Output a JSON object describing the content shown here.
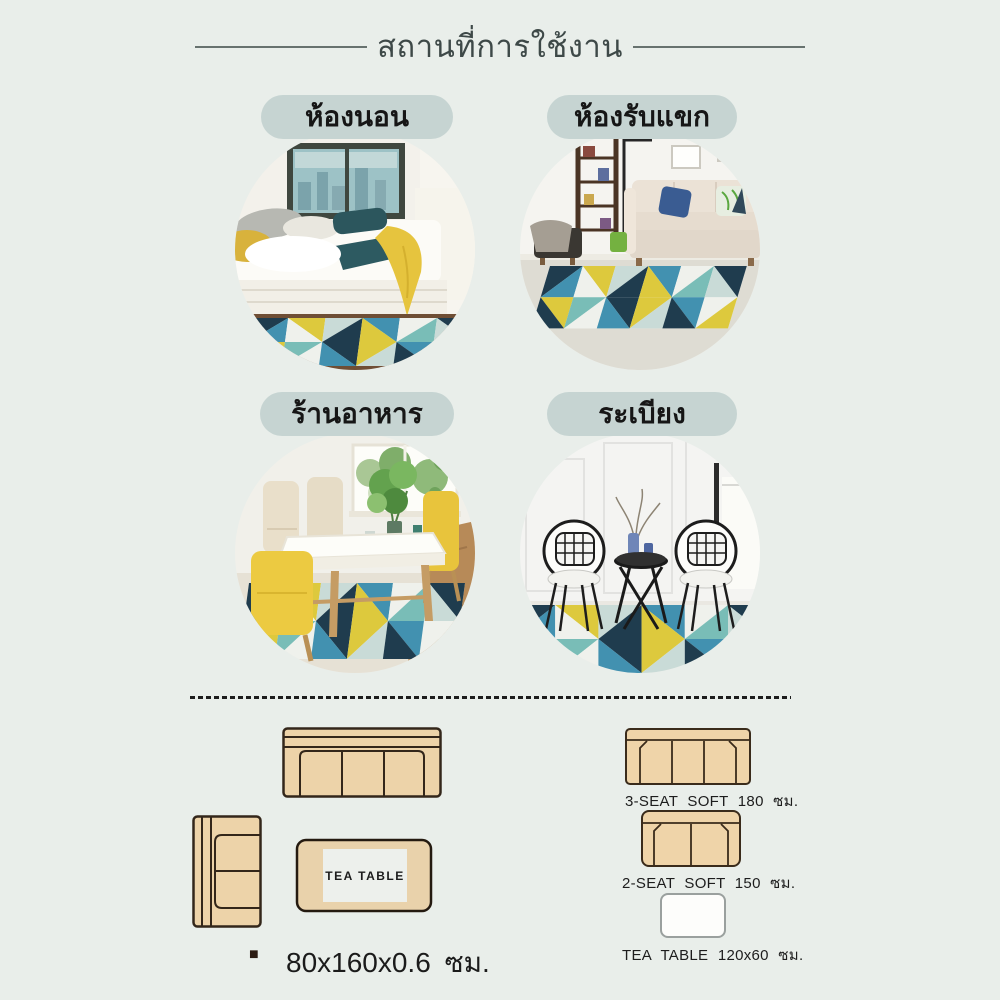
{
  "header": {
    "title": "สถานที่การใช้งาน"
  },
  "locations": [
    {
      "id": "bedroom",
      "label": "ห้องนอน"
    },
    {
      "id": "living-room",
      "label": "ห้องรับแขก"
    },
    {
      "id": "restaurant",
      "label": "ร้านอาหาร"
    },
    {
      "id": "balcony",
      "label": "ระเบียง"
    }
  ],
  "size_guide": {
    "left": {
      "tea_table_label": "TEA TABLE",
      "bullet": "■",
      "rug_size": "80x160x0.6 ซม."
    },
    "right": [
      {
        "label": "3-SEAT SOFT 180 ซม."
      },
      {
        "label": "2-SEAT SOFT 150 ซม."
      },
      {
        "label": "TEA TABLE 120x60 ซม."
      }
    ]
  },
  "colors": {
    "background": "#e9eeea",
    "pill_background": "#c6d4d2",
    "title_text": "#3e4948",
    "divider_dots": "#1d1d1d",
    "sofa_diagram_fill": "#edd3a9",
    "sofa_diagram_outline": "#33261a",
    "rug_yellow": "#ddc93d",
    "rug_steel_blue": "#4291b0",
    "rug_navy": "#1f3c4e",
    "rug_light_teal": "#79bdb7",
    "rug_white": "#eff1ec",
    "rug_gray": "#c9dbd7"
  }
}
